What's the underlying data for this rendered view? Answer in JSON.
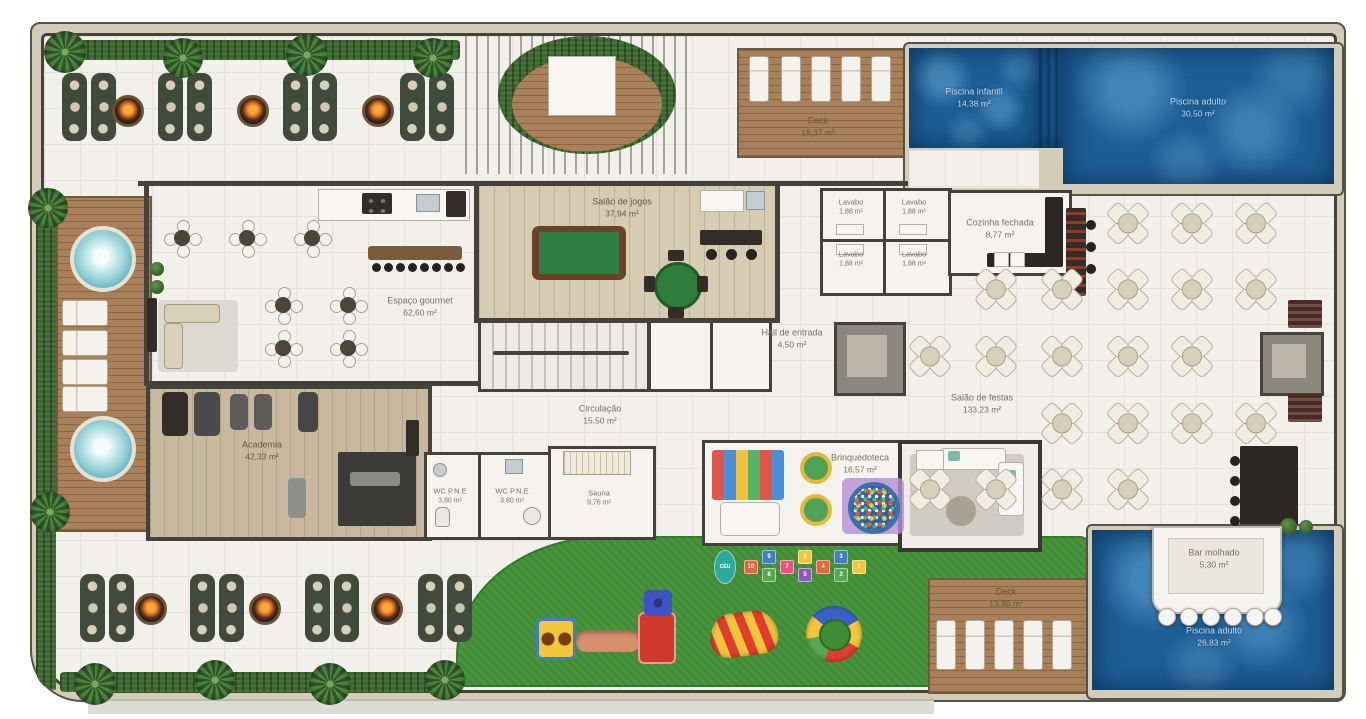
{
  "rooms": {
    "piscina_infantil": {
      "name": "Piscina infantil",
      "area": "14,38 m²"
    },
    "piscina_adulto_top": {
      "name": "Piscina adulto",
      "area": "30,50 m²"
    },
    "deck_top": {
      "name": "Deck",
      "area": "18,37 m²"
    },
    "salao_jogos": {
      "name": "Salão de jogos",
      "area": "37,94 m²"
    },
    "lavabo": {
      "name": "Lavabo",
      "area": "1,88 m²"
    },
    "cozinha_fechada": {
      "name": "Cozinha fechada",
      "area": "8,77 m²"
    },
    "espaco_gourmet": {
      "name": "Espaço gourmet",
      "area": "62,60 m²"
    },
    "hall_entrada": {
      "name": "Hall de entrada",
      "area": "4,50 m²"
    },
    "salao_festas": {
      "name": "Salão de festas",
      "area": "133,23 m²"
    },
    "circulacao": {
      "name": "Circulação",
      "area": "15,50 m²"
    },
    "academia": {
      "name": "Academia",
      "area": "42,33 m²"
    },
    "wc_pne": {
      "name": "WC P.N.E",
      "area": "3,80 m²"
    },
    "sauna": {
      "name": "Sauna",
      "area": "9,76 m²"
    },
    "brinquedoteca": {
      "name": "Brinquedoteca",
      "area": "16,57 m²"
    },
    "bar_molhado": {
      "name": "Bar molhado",
      "area": "5,30 m²"
    },
    "deck_bottom": {
      "name": "Deck",
      "area": "13,90 m²"
    },
    "piscina_adulto_bottom": {
      "name": "Piscina adulto",
      "area": "26,83 m²"
    }
  },
  "playground": {
    "hopscotch_numbers": [
      "CÉU",
      "10",
      "9",
      "8",
      "7",
      "6",
      "5",
      "4",
      "3",
      "2",
      "1"
    ]
  },
  "colors": {
    "pool_water": "#1d5e95",
    "grass": "#47953c",
    "deck_wood": "#a8805a",
    "wall": "#45423c",
    "stone_band": "#d3ccb7",
    "fire": "#e06818",
    "felt_green": "#2f8040"
  }
}
